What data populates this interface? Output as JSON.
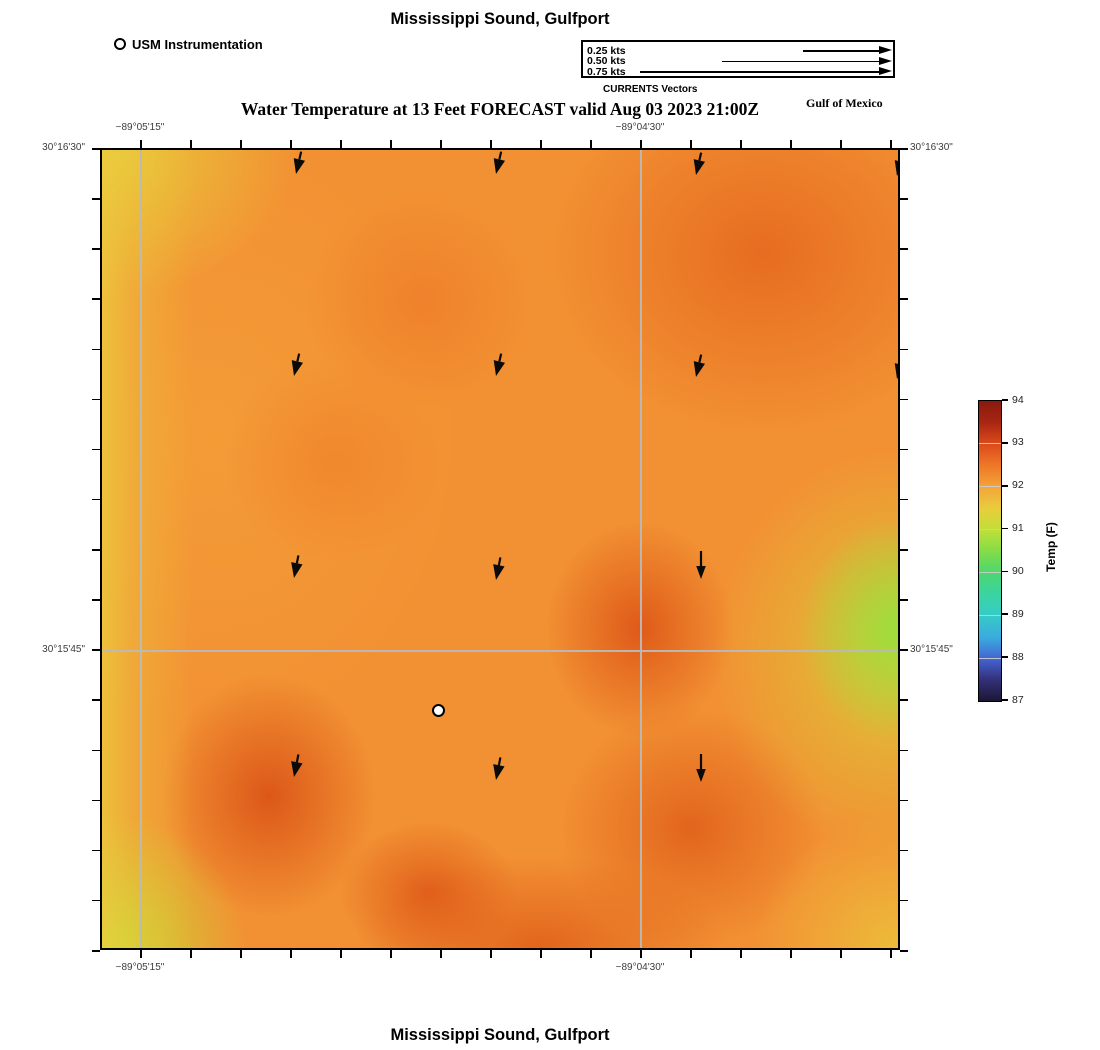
{
  "figure": {
    "top_title": "Mississippi Sound, Gulfport",
    "subtitle": "Water Temperature at 13 Feet FORECAST valid Aug 03 2023 21:00Z",
    "region_label": "Gulf of Mexico",
    "bottom_title": "Mississippi Sound, Gulfport"
  },
  "usm_legend": {
    "label": "USM Instrumentation"
  },
  "vector_legend": {
    "caption": "CURRENTS Vectors",
    "items": [
      {
        "label": "0.25 kts",
        "line_start": 220,
        "row_center": 9
      },
      {
        "label": "0.50 kts",
        "line_start": 139,
        "row_center": 19.5
      },
      {
        "label": "0.75 kts",
        "line_start": 57,
        "row_center": 30
      }
    ],
    "line_end": 307
  },
  "axes": {
    "top": [
      {
        "text": "−89°05'15\"",
        "x": 140
      },
      {
        "text": "−89°04'30\"",
        "x": 640
      }
    ],
    "bottom": [
      {
        "text": "−89°05'15\"",
        "x": 140
      },
      {
        "text": "−89°04'30\"",
        "x": 640
      }
    ],
    "left": [
      {
        "text": "30°16'30\"",
        "y": 148
      },
      {
        "text": "30°15'45\"",
        "y": 650
      }
    ],
    "right": [
      {
        "text": "30°16'30\"",
        "y": 148
      },
      {
        "text": "30°15'45\"",
        "y": 650
      }
    ],
    "gridlines_x_px": [
      40,
      540
    ],
    "gridline_y_px": 502,
    "tick_top_start": 140,
    "tick_step_x": 50,
    "tick_count_x": 16,
    "tick_left_start": 148,
    "tick_step_y": 50.125,
    "tick_count_y": 17
  },
  "colorbar": {
    "label": "Temp (F)",
    "ticks": [
      "94",
      "93",
      "92",
      "91",
      "90",
      "89",
      "88",
      "87"
    ],
    "gradient": [
      {
        "pos": 0,
        "color": "#8a190d"
      },
      {
        "pos": 7,
        "color": "#a82513"
      },
      {
        "pos": 14,
        "color": "#d9491a"
      },
      {
        "pos": 21,
        "color": "#ee7427"
      },
      {
        "pos": 29,
        "color": "#f3a73a"
      },
      {
        "pos": 36,
        "color": "#e9cd3c"
      },
      {
        "pos": 43,
        "color": "#c0df39"
      },
      {
        "pos": 50,
        "color": "#84dc47"
      },
      {
        "pos": 57,
        "color": "#4ed76e"
      },
      {
        "pos": 64,
        "color": "#3bd49f"
      },
      {
        "pos": 71,
        "color": "#36cdc4"
      },
      {
        "pos": 79,
        "color": "#3aaade"
      },
      {
        "pos": 86,
        "color": "#4463d2"
      },
      {
        "pos": 93,
        "color": "#333078"
      },
      {
        "pos": 100,
        "color": "#1c1735"
      }
    ]
  },
  "chart_data": {
    "type": "heatmap",
    "title": "Water Temperature at 13 Feet FORECAST valid Aug 03 2023 21:00Z",
    "place": "Mississippi Sound, Gulfport",
    "colorbar_label": "Temp (F)",
    "colorbar_range": [
      87,
      94
    ],
    "x_tick_labels": [
      "−89°05'15\"",
      "−89°04'30\""
    ],
    "y_tick_labels": [
      "30°16'30\"",
      "30°15'45\""
    ],
    "grid_on": true,
    "legend_position": "top",
    "temperature_grid_f_estimated": [
      [
        91.6,
        92.2,
        92.4,
        92.6,
        92.5
      ],
      [
        91.8,
        92.3,
        92.3,
        92.4,
        92.6
      ],
      [
        91.9,
        92.3,
        92.4,
        92.9,
        91.0
      ],
      [
        91.9,
        92.8,
        92.4,
        92.9,
        91.8
      ],
      [
        91.3,
        92.4,
        92.8,
        92.6,
        91.7
      ]
    ],
    "current_vectors": [
      {
        "x": 196,
        "y": 26,
        "tilt": 13,
        "long": false
      },
      {
        "x": 396,
        "y": 26,
        "tilt": 13,
        "long": false
      },
      {
        "x": 596,
        "y": 27,
        "tilt": 13,
        "long": false
      },
      {
        "x": 797,
        "y": 28,
        "tilt": 13,
        "long": false
      },
      {
        "x": 194,
        "y": 228,
        "tilt": 13,
        "long": false
      },
      {
        "x": 396,
        "y": 228,
        "tilt": 13,
        "long": false
      },
      {
        "x": 596,
        "y": 229,
        "tilt": 13,
        "long": false
      },
      {
        "x": 797,
        "y": 231,
        "tilt": 13,
        "long": false
      },
      {
        "x": 194,
        "y": 430,
        "tilt": 11,
        "long": false
      },
      {
        "x": 396,
        "y": 432,
        "tilt": 11,
        "long": false
      },
      {
        "x": 601,
        "y": 431,
        "tilt": 0,
        "long": true
      },
      {
        "x": 194,
        "y": 629,
        "tilt": 11,
        "long": false
      },
      {
        "x": 396,
        "y": 632,
        "tilt": 11,
        "long": false
      },
      {
        "x": 601,
        "y": 634,
        "tilt": 0,
        "long": true
      }
    ],
    "station_marker": {
      "x": 337,
      "y": 561,
      "label": "USM Instrumentation"
    }
  }
}
